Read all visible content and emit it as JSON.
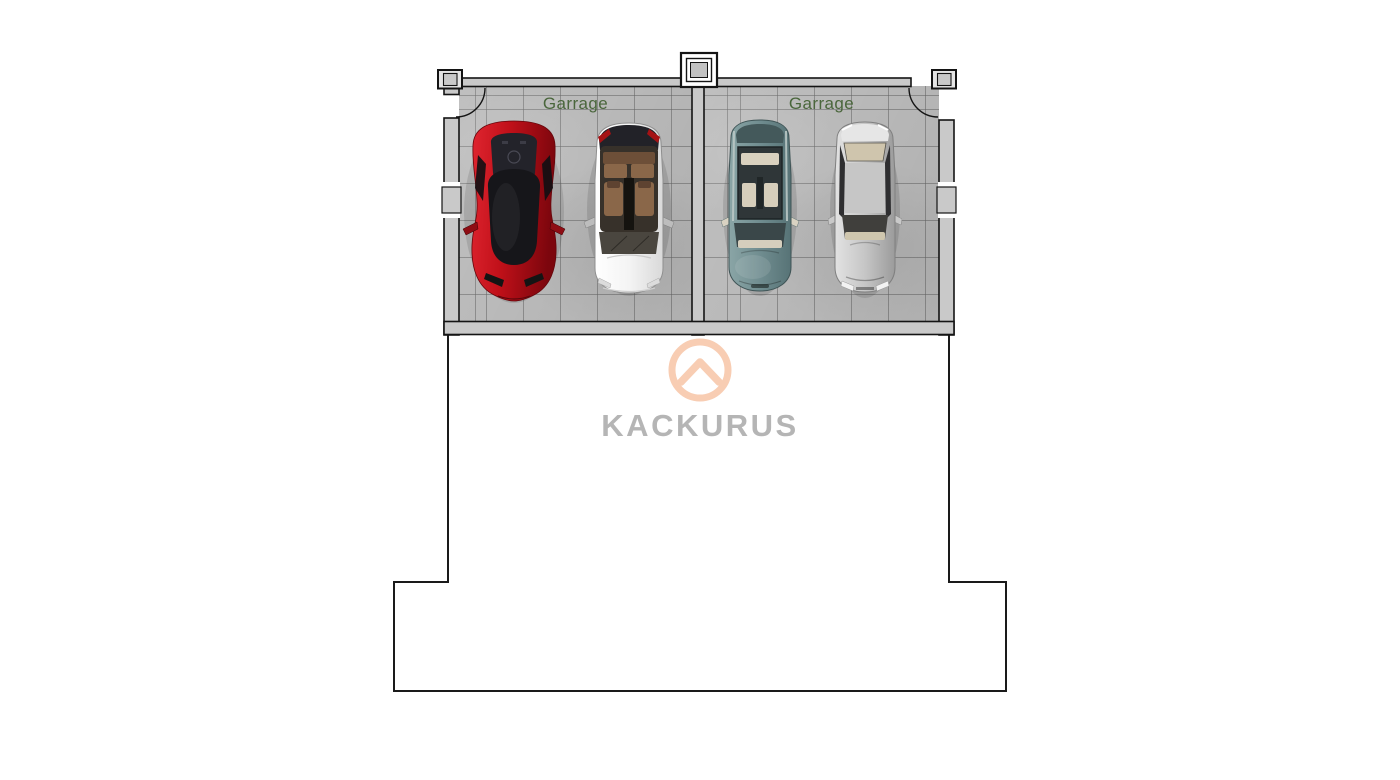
{
  "brand": {
    "name": "KACKURUS"
  },
  "garages": [
    {
      "label": "Garrage",
      "vehicles": [
        "red sports car",
        "white compact car"
      ]
    },
    {
      "label": "Garrage",
      "vehicles": [
        "teal sedan",
        "silver sedan"
      ]
    }
  ],
  "colors": {
    "accent_peach": "#f8cdb3",
    "brand_text_gray": "#b5b5b5",
    "room_label_green": "#4a663c",
    "wall_fill_gray": "#c9c9c9",
    "floor_gray": "#b9b9b9",
    "outline_black": "#1a1a1a",
    "car_red": "#b3101b",
    "car_white": "#f2f2f2",
    "car_teal": "#6c898c",
    "car_silver": "#c0c0c0"
  }
}
